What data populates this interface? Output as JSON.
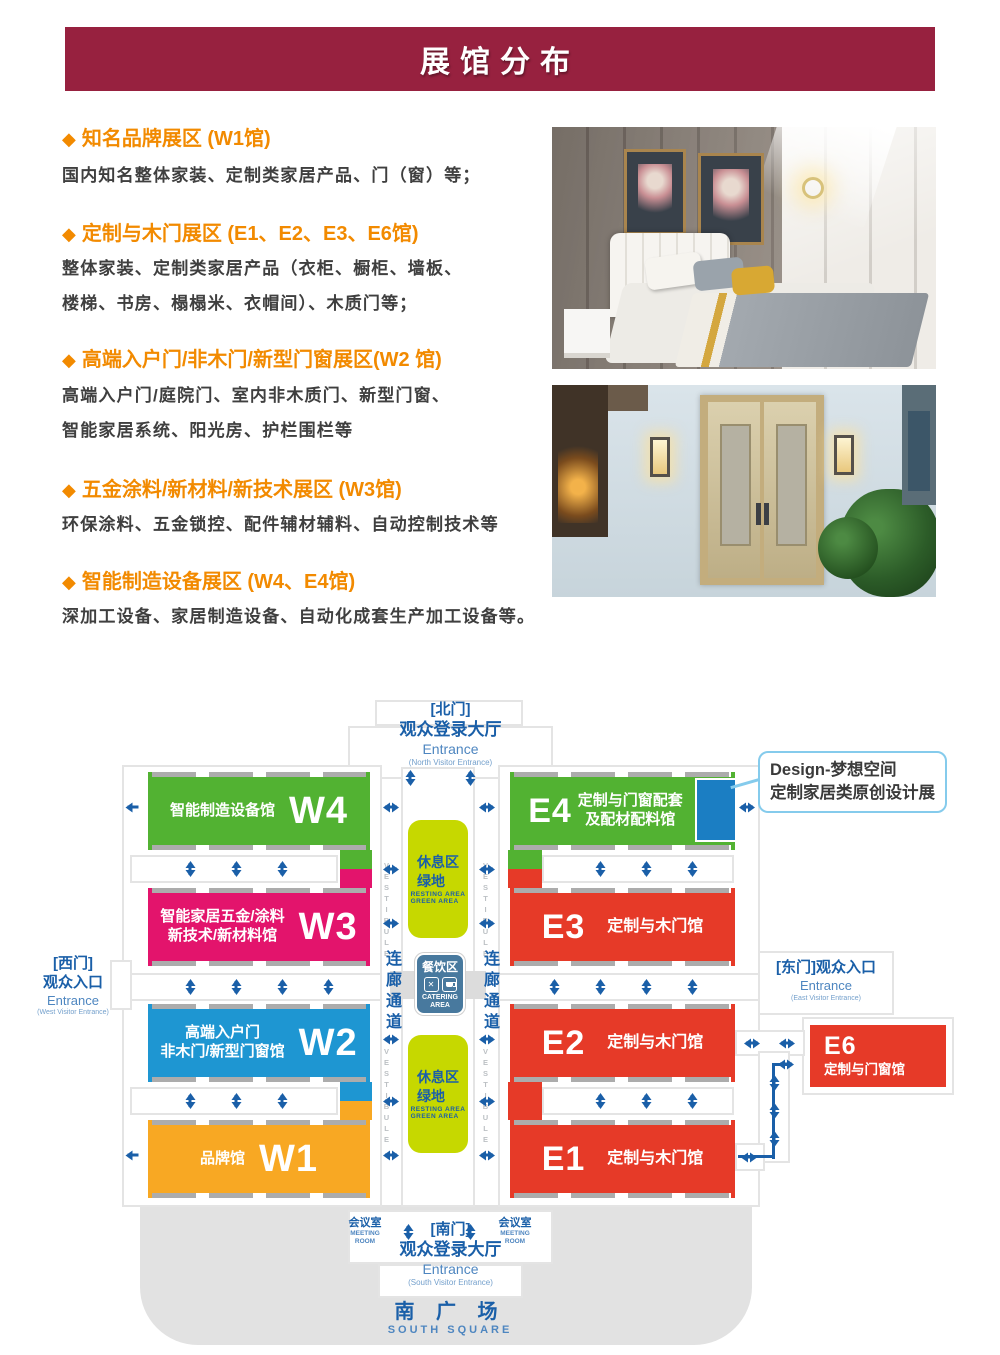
{
  "header": {
    "title": "展馆分布"
  },
  "bullet": "◆",
  "sections": [
    {
      "heading": "知名品牌展区 (W1馆)",
      "body": [
        "国内知名整体家装、定制类家居产品、门（窗）等；"
      ]
    },
    {
      "heading": "定制与木门展区 (E1、E2、E3、E6馆)",
      "body": [
        "整体家装、定制类家居产品（衣柜、橱柜、墙板、",
        "楼梯、书房、榻榻米、衣帽间）、木质门等；"
      ]
    },
    {
      "heading": "高端入户门/非木门/新型门窗展区(W2 馆)",
      "body": [
        "高端入户门/庭院门、室内非木质门、新型门窗、",
        "智能家居系统、阳光房、护栏围栏等"
      ]
    },
    {
      "heading": "五金涂料/新材料/新技术展区 (W3馆)",
      "body": [
        "环保涂料、五金锁控、配件辅材辅料、自动控制技术等"
      ]
    },
    {
      "heading": "智能制造设备展区 (W4、E4馆)",
      "body": [
        "深加工设备、家居制造设备、自动化成套生产加工设备等。"
      ]
    }
  ],
  "map": {
    "gates": {
      "north": {
        "l1": "[北门]",
        "l2": "观众登录大厅",
        "l3": "Entrance",
        "l4": "(North Visitor Entrance)"
      },
      "south": {
        "l1": "[南门]",
        "l2": "观众登录大厅",
        "l3": "Entrance",
        "l4": "(South Visitor Entrance)"
      },
      "west": {
        "l1": "[西门]",
        "l2": "观众入口",
        "l3": "Entrance",
        "l4": "(West Visitor Entrance)"
      },
      "east": {
        "l1": "[东门]观众入口",
        "l2": "Entrance",
        "l3": "(East Visitor Entrance)"
      }
    },
    "south_square": {
      "cn": "南 广 场",
      "en": "SOUTH  SQUARE"
    },
    "meeting_room": {
      "cn": "会议室",
      "en1": "MEETING",
      "en2": "ROOM"
    },
    "rest_area": {
      "cn1": "休息区",
      "cn2": "绿地",
      "en1": "RESTING AREA",
      "en2": "GREEN AREA"
    },
    "catering": {
      "cn": "餐饮区",
      "en1": "CATERING",
      "en2": "AREA",
      "icons": [
        "utensils-icon",
        "cup-icon"
      ]
    },
    "corridor": "连廊通道",
    "vestibule": "VESTIBULE",
    "halls": {
      "W4": {
        "code": "W4",
        "l1": "智能制造设备馆",
        "l2": ""
      },
      "W3": {
        "code": "W3",
        "l1": "智能家居五金/涂料",
        "l2": "新技术/新材料馆"
      },
      "W2": {
        "code": "W2",
        "l1": "高端入户门",
        "l2": "非木门/新型门窗馆"
      },
      "W1": {
        "code": "W1",
        "l1": "品牌馆",
        "l2": ""
      },
      "E4": {
        "code": "E4",
        "l1": "定制与门窗配套",
        "l2": "及配材配料馆"
      },
      "E3": {
        "code": "E3",
        "l1": "定制与木门馆",
        "l2": ""
      },
      "E2": {
        "code": "E2",
        "l1": "定制与木门馆",
        "l2": ""
      },
      "E1": {
        "code": "E1",
        "l1": "定制与木门馆",
        "l2": ""
      },
      "E6": {
        "code": "E6",
        "l1": "定制与门窗馆",
        "l2": ""
      }
    },
    "callout": {
      "l1": "Design-梦想空间",
      "l2": "定制家居类原创设计展"
    }
  },
  "colors": {
    "banner": "#97213F",
    "orange": "#F28A00",
    "text": "#3F3F3F",
    "mb": "#1A5FA8",
    "mben": "#4E86C0",
    "mbsm": "#74A0CC",
    "green": "#52B232",
    "magenta": "#E3146C",
    "blue": "#1E96D2",
    "orangeHall": "#F8A823",
    "red": "#E63A28",
    "rest": "#C6D800",
    "cat": "#48799E",
    "design": "#1B7EC3"
  }
}
